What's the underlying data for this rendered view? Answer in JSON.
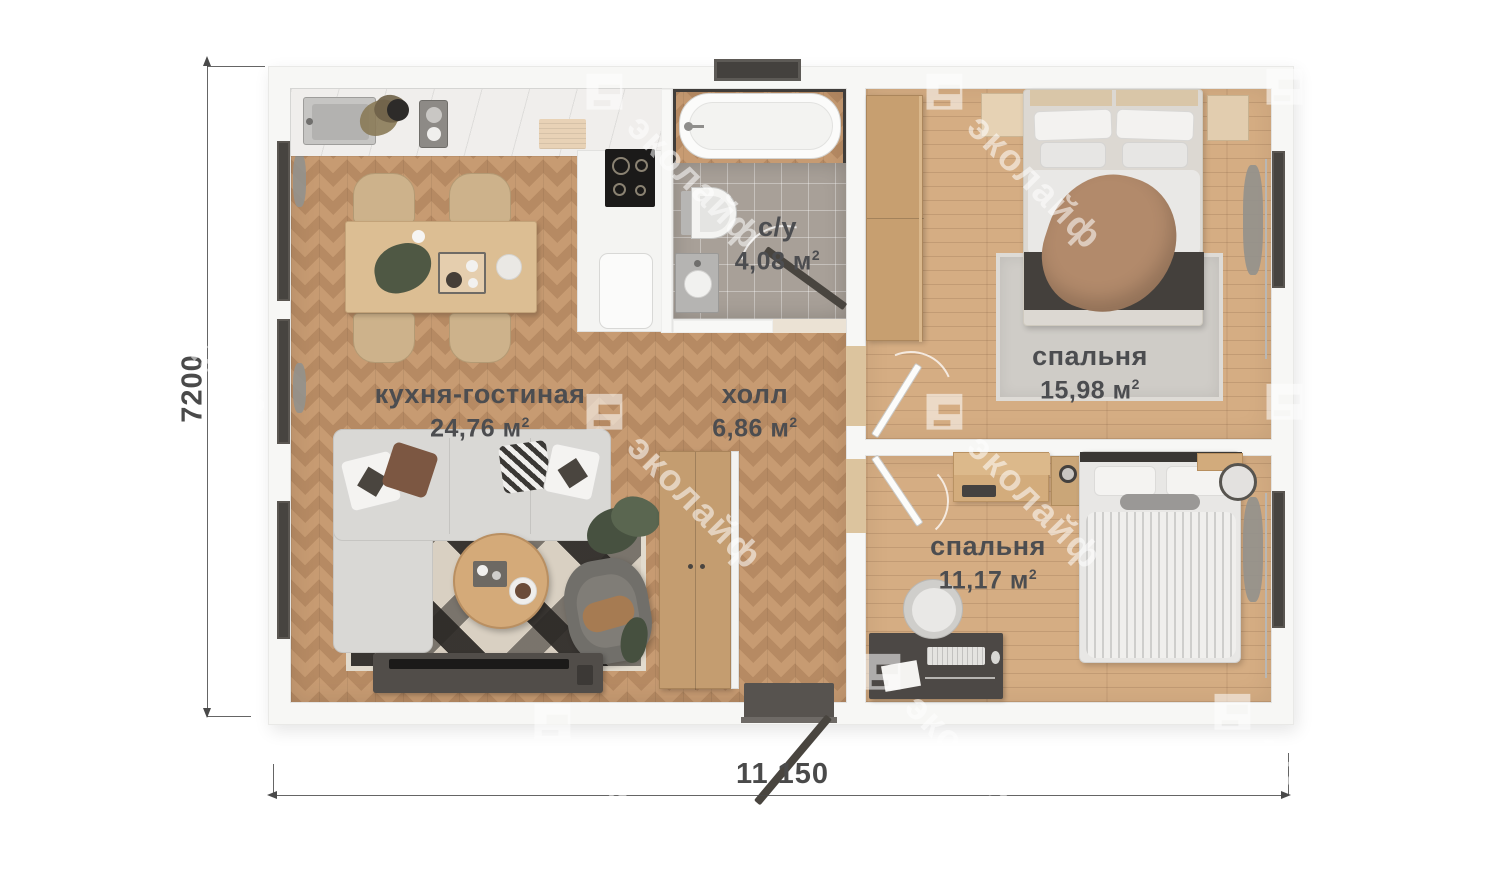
{
  "watermark": {
    "text": "эколайф"
  },
  "dimensions": {
    "bottom": "11 150",
    "left": "7200"
  },
  "rooms": {
    "kitchen_living": {
      "name": "кухня-гостиная",
      "area": "24,76",
      "unit": "м",
      "sup": "2"
    },
    "hall": {
      "name": "холл",
      "area": "6,86",
      "unit": "м",
      "sup": "2"
    },
    "bathroom": {
      "name": "с/у",
      "area": "4,08",
      "unit": "м",
      "sup": "2"
    },
    "bedroom_large": {
      "name": "спальня",
      "area": "15,98",
      "unit": "м",
      "sup": "2"
    },
    "bedroom_small": {
      "name": "спальня",
      "area": "11,17",
      "unit": "м",
      "sup": "2"
    }
  }
}
